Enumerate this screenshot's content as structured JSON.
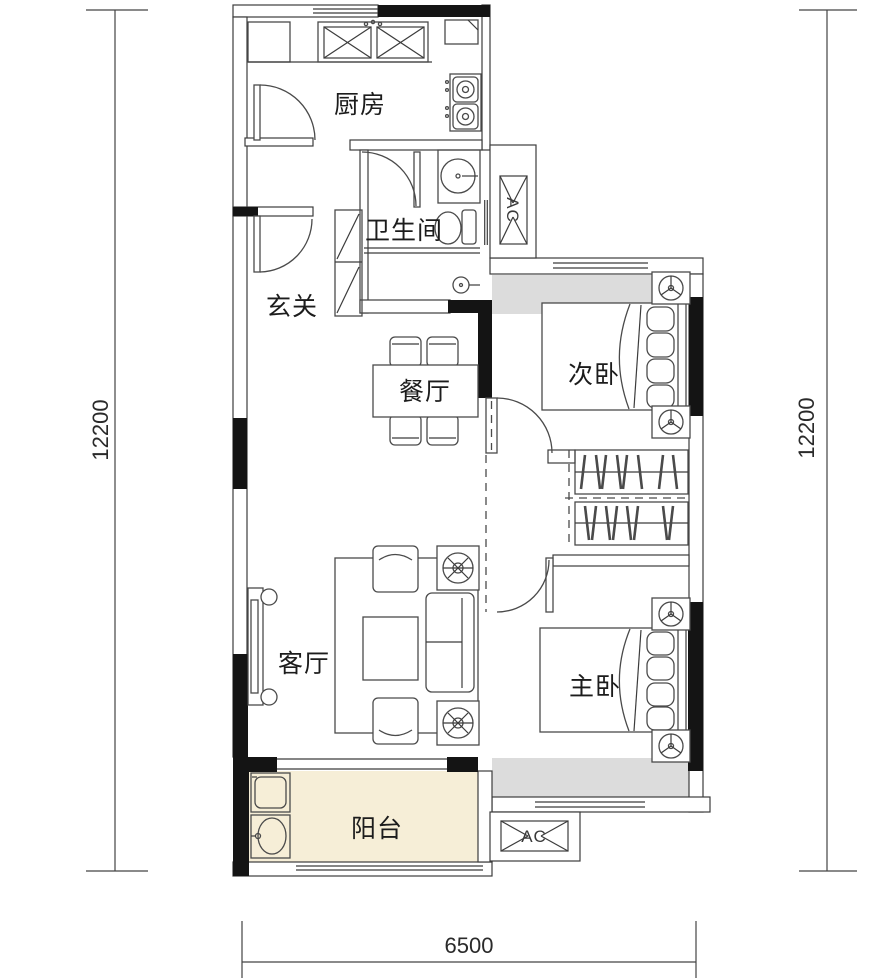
{
  "floor_plan": {
    "rooms": {
      "kitchen": {
        "label": "厨房"
      },
      "bathroom": {
        "label": "卫生间"
      },
      "entrance": {
        "label": "玄关"
      },
      "dining": {
        "label": "餐厅"
      },
      "second_bedroom": {
        "label": "次卧"
      },
      "living": {
        "label": "客厅"
      },
      "master_bedroom": {
        "label": "主卧"
      },
      "balcony": {
        "label": "阳台"
      }
    },
    "ac_units": [
      {
        "label": "AC"
      },
      {
        "label": "AC"
      }
    ],
    "dimensions": {
      "left": "12200",
      "right": "12200",
      "bottom": "6500"
    },
    "colors": {
      "wall": "#141414",
      "line": "#3c3c3c",
      "balcony_fill": "#f6eed7",
      "bay_fill": "#dcdcdc"
    }
  }
}
